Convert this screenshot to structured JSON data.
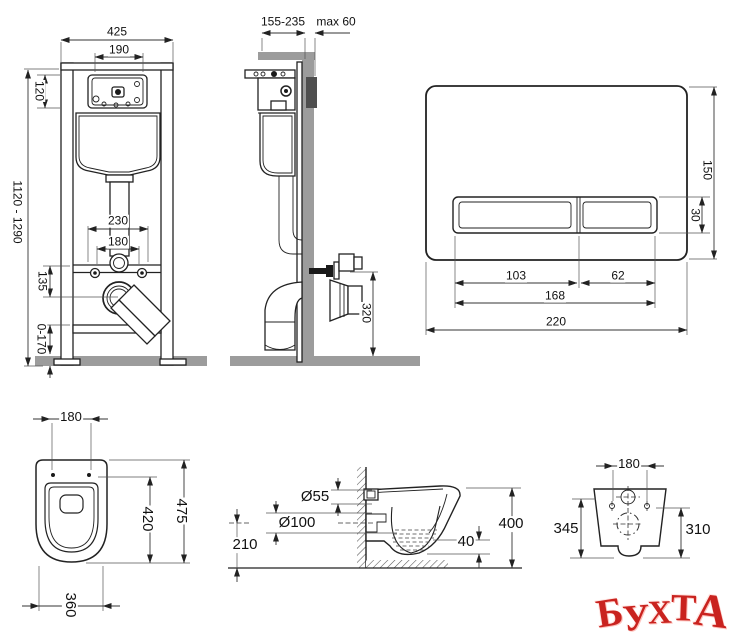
{
  "page": {
    "background": "#ffffff",
    "line_color": "#222222",
    "gray_fill": "#9c9c9c",
    "watermark_color": "#c9231f"
  },
  "frame_front": {
    "width": "425",
    "cistern_window_width": "190",
    "cistern_window_height": "120",
    "installation_height": "1120 - 1290",
    "fixing_span": "230",
    "pipe_span": "180",
    "drain_offset": "135",
    "leg_adjustment": "0-170"
  },
  "frame_side": {
    "depth": "155-235",
    "wall_thickness": "max 60",
    "outlet_height": "320"
  },
  "flush_plate": {
    "plate_height": "150",
    "button_height": "30",
    "large_button_width": "103",
    "small_button_width": "62",
    "buttons_width": "168",
    "plate_width": "220"
  },
  "toilet_top": {
    "fixing_span": "180",
    "seat_length": "420",
    "total_length": "475",
    "width": "360"
  },
  "toilet_side": {
    "inlet_diameter": "Ø55",
    "outlet_diameter": "Ø100",
    "outlet_height": "210",
    "bowl_drop": "40",
    "depth": "400"
  },
  "toilet_rear": {
    "fixing_span": "180",
    "height_left": "345",
    "height_right": "310"
  },
  "watermark": {
    "text": "БУХТА",
    "letters": [
      "Б",
      "У",
      "Х",
      "Т",
      "А"
    ]
  }
}
